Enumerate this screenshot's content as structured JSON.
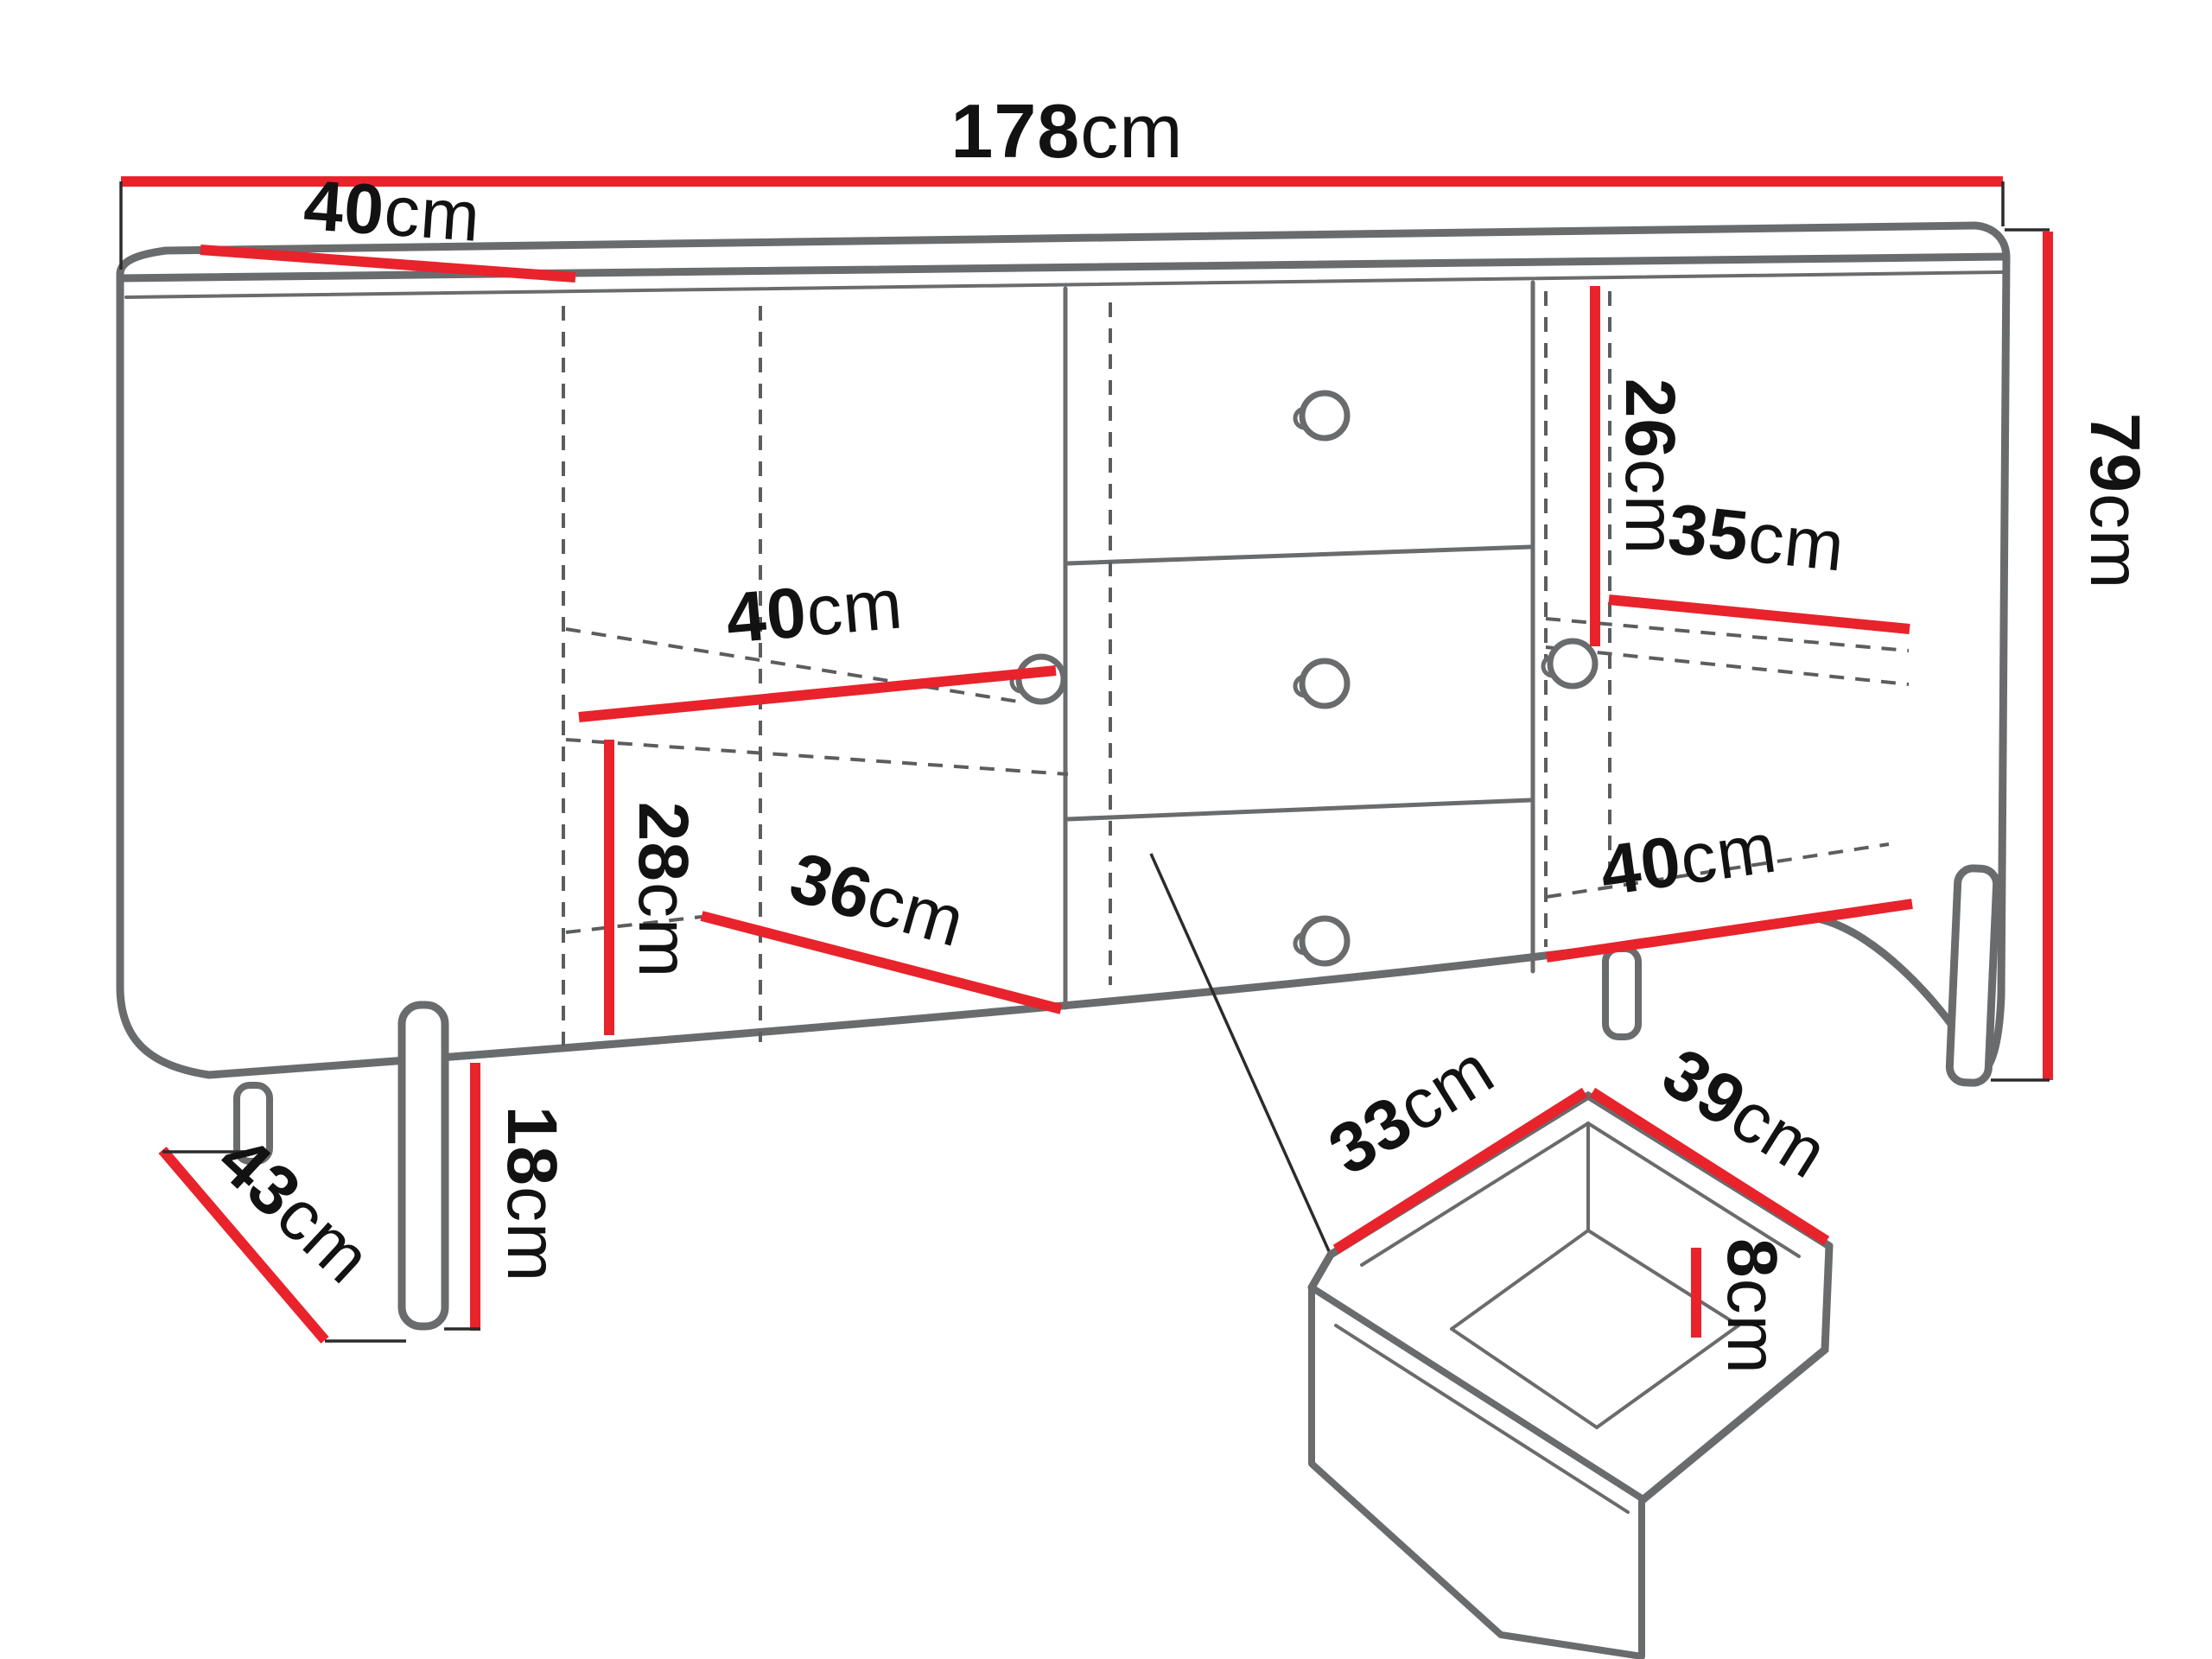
{
  "page": {
    "title": "Sideboard technical dimensions drawing",
    "background": "#ffffff"
  },
  "colors": {
    "dimension_red": "#e8232b",
    "cabinet_outline_gray": "#6a6b6d",
    "hidden_line_gray": "#5c5d5f",
    "tick_black": "#2b2b2b",
    "label_text": "#121212"
  },
  "dimensions": {
    "total_width": {
      "num": "178",
      "unit": "cm"
    },
    "top_depth": {
      "num": "40",
      "unit": "cm"
    },
    "total_height": {
      "num": "79",
      "unit": "cm"
    },
    "right_top_gap": {
      "num": "26",
      "unit": "cm"
    },
    "right_shelf_width": {
      "num": "35",
      "unit": "cm"
    },
    "left_shelf_width": {
      "num": "40",
      "unit": "cm"
    },
    "left_compartment_height": {
      "num": "28",
      "unit": "cm"
    },
    "left_compartment_depth": {
      "num": "36",
      "unit": "cm"
    },
    "right_bottom_width": {
      "num": "40",
      "unit": "cm"
    },
    "leg_height": {
      "num": "18",
      "unit": "cm"
    },
    "base_depth": {
      "num": "43",
      "unit": "cm"
    },
    "drawer_depth": {
      "num": "33",
      "unit": "cm"
    },
    "drawer_width": {
      "num": "39",
      "unit": "cm"
    },
    "drawer_inner_height": {
      "num": "8",
      "unit": "cm"
    }
  }
}
